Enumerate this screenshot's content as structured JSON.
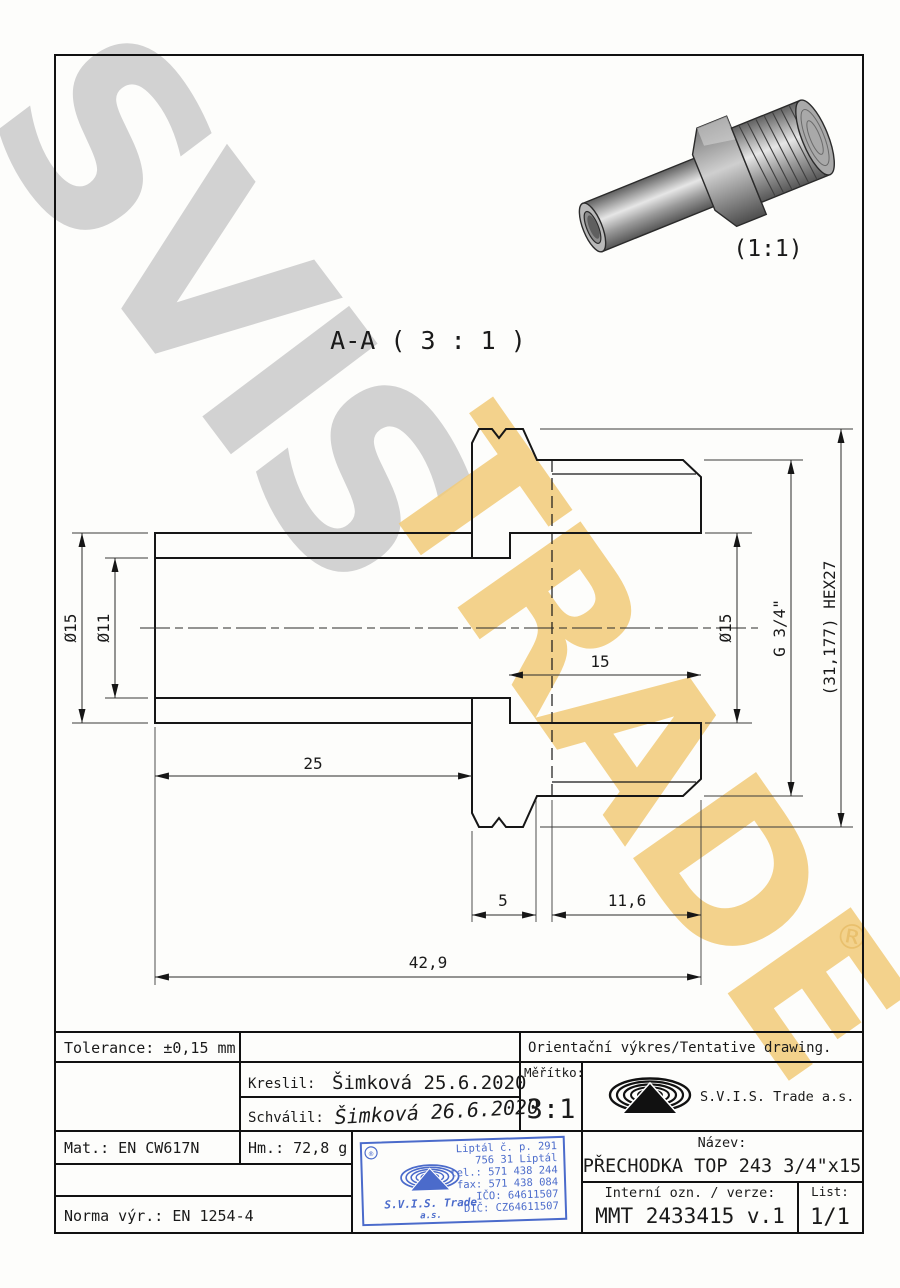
{
  "watermark": {
    "word1": "SVIS",
    "word2": "TRADE",
    "registered": "®"
  },
  "views": {
    "section_label": "A-A ( 3 : 1 )",
    "thumb_scale_label": "(1:1)"
  },
  "dims": {
    "d_outer_left": "Ø15",
    "d_inner_left": "Ø11",
    "d_bore_right": "Ø15",
    "thread": "G 3/4\"",
    "hex": "(31,177) HEX27",
    "len_bore": "15",
    "len_tube": "25",
    "len_hex": "5",
    "len_thread": "11,6",
    "len_total": "42,9"
  },
  "title_block": {
    "tolerance": "Tolerance: ±0,15 mm",
    "orientation_note": "Orientační výkres/Tentative drawing.",
    "kreslil_label": "Kreslil:",
    "kreslil_value": "Šimková 25.6.2020",
    "schvalil_label": "Schválil:",
    "schvalil_value": "Šimková 26.6.2020",
    "meritko_label": "Měřítko:",
    "meritko_value": "3:1",
    "company": "S.V.I.S. Trade a.s.",
    "mat": "Mat.: EN CW617N",
    "hm": "Hm.: 72,8 g",
    "norma": "Norma výr.: EN 1254-4",
    "nazev_label": "Název:",
    "nazev_value": "PŘECHODKA TOP 243 3/4\"x15",
    "interni_label": "Interní ozn. / verze:",
    "interni_value": "MMT 2433415 v.1",
    "list_label": "List:",
    "list_value": "1/1"
  },
  "stamp": {
    "registered": "®",
    "company_line1": "S.V.I.S. Trade",
    "company_line2": "a.s.",
    "address": [
      "Liptál č. p. 291",
      "756 31 Liptál",
      "tel.: 571 438 244",
      "fax: 571 438 084",
      "IČO: 64611507",
      "DIČ: CZ64611507"
    ]
  },
  "colors": {
    "stamp_blue": "#3c5fc7",
    "signature_blue": "#2b50c8",
    "watermark_gray": "#d2d2d2",
    "watermark_yellow": "#f2cb79"
  }
}
